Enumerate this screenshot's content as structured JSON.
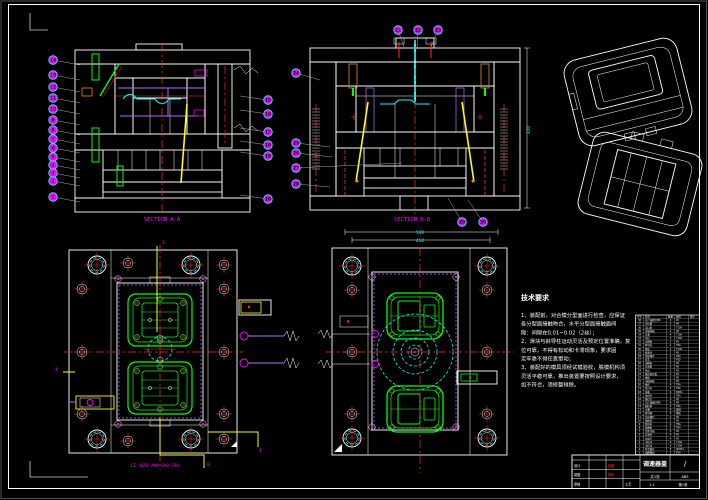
{
  "drawing": {
    "section_a_label": "SECTION A-A",
    "section_b_label": "SECTION B-B",
    "plan_caption": "CI-4050-A90-B90-C90",
    "dim_top_1": "540",
    "dim_top_2": "450",
    "dim_right_b": "320",
    "leader_numbers": [
      "3",
      "8",
      "4",
      "4"
    ]
  },
  "colors": {
    "accent_magenta": "#ff00ff",
    "accent_cyan": "#00ffff",
    "accent_green": "#00ff00",
    "accent_yellow": "#ffff00",
    "accent_red": "#ff2a2a",
    "line_white": "#ffffff"
  },
  "tech_req": {
    "title": "技术要求",
    "lines": [
      "1、装配前，对合模分型面进行检查，应保证",
      "各分型面接触吻合，水平分型面接触面间",
      "隙：间隙在0.01~0.02（2丝）；",
      "2、滑块与斜导柱运动灵活及预定位置准确，复",
      "位可靠，不得有松动和卡滞现象，要求固",
      "定牢靠不得任意窜动；",
      "3、装配好的模具须经试模验收，脱模机构须",
      "灵活平稳可靠，推出装置要按照设计要求，",
      "如不符合，须修整排除。"
    ]
  },
  "balloons": {
    "a_left": [
      "14",
      "13",
      "12",
      "11",
      "10",
      "9",
      "8",
      "7",
      "6",
      "5",
      "4",
      "3",
      "2",
      "1"
    ],
    "a_right": [
      "15",
      "16",
      "17",
      "18",
      "19",
      "20"
    ],
    "b_top": [
      "21",
      "22",
      "23"
    ],
    "b_left_top": [
      "24"
    ],
    "b_left": [
      "25",
      "26",
      "27",
      "28"
    ],
    "b_bottom": [
      "29",
      "30"
    ]
  },
  "bom": {
    "headers": [
      "序号",
      "名称",
      "数量",
      "材料",
      "备注"
    ],
    "rows": [
      [
        "38",
        "内六角螺钉M8",
        "4",
        "45",
        ""
      ],
      [
        "37",
        "定位圈",
        "1",
        "45",
        ""
      ],
      [
        "36",
        "浇口套",
        "1",
        "T10A",
        ""
      ],
      [
        "35",
        "定模座板",
        "1",
        "45",
        ""
      ],
      [
        "34",
        "导套",
        "4",
        "T10A",
        ""
      ],
      [
        "33",
        "导柱",
        "4",
        "T10A",
        ""
      ],
      [
        "32",
        "定模板",
        "1",
        "45",
        ""
      ],
      [
        "31",
        "斜导柱",
        "2",
        "T8A",
        ""
      ],
      [
        "30",
        "滑块",
        "2",
        "T10A",
        ""
      ],
      [
        "29",
        "楔紧块",
        "2",
        "45",
        ""
      ],
      [
        "28",
        "型腔镶件",
        "2",
        "P20",
        ""
      ],
      [
        "27",
        "型芯",
        "2",
        "P20",
        ""
      ],
      [
        "26",
        "动模板",
        "1",
        "45",
        ""
      ],
      [
        "25",
        "支承板",
        "1",
        "45",
        ""
      ],
      [
        "24",
        "垫块",
        "2",
        "45",
        ""
      ],
      [
        "23",
        "推杆固定板",
        "1",
        "45",
        ""
      ],
      [
        "22",
        "推板",
        "1",
        "45",
        ""
      ],
      [
        "21",
        "动模座板",
        "1",
        "45",
        ""
      ],
      [
        "20",
        "推杆",
        "8",
        "T8A",
        ""
      ],
      [
        "19",
        "复位杆",
        "4",
        "T8A",
        ""
      ],
      [
        "18",
        "弹簧",
        "4",
        "65Mn",
        ""
      ],
      [
        "17",
        "拉料杆",
        "1",
        "T8A",
        ""
      ],
      [
        "16",
        "限位钉",
        "4",
        "45",
        ""
      ],
      [
        "15",
        "内六角螺钉M6",
        "6",
        "45",
        ""
      ],
      [
        "14",
        "圆柱销",
        "4",
        "T8A",
        ""
      ],
      [
        "13",
        "水嘴",
        "8",
        "黄铜",
        ""
      ],
      [
        "12",
        "密封圈",
        "8",
        "橡胶",
        ""
      ],
      [
        "11",
        "吊环螺钉",
        "2",
        "45",
        ""
      ],
      [
        "10",
        "锁模块",
        "2",
        "45",
        ""
      ],
      [
        "9",
        "斜顶杆",
        "2",
        "T8A",
        ""
      ],
      [
        "8",
        "耐磨板",
        "2",
        "T8A",
        ""
      ],
      [
        "7",
        "定距拉板",
        "2",
        "45",
        ""
      ],
      [
        "6",
        "支承柱",
        "4",
        "45",
        ""
      ],
      [
        "5",
        "垃圾钉",
        "4",
        "45",
        ""
      ],
      [
        "4",
        "中托司",
        "4",
        "T10A",
        ""
      ],
      [
        "3",
        "中托边",
        "4",
        "T10A",
        ""
      ],
      [
        "2",
        "型芯镶针",
        "8",
        "SKH51",
        ""
      ],
      [
        "1",
        "动模镶块",
        "2",
        "P20",
        ""
      ]
    ]
  },
  "title_block": {
    "part_name": "调速器盖",
    "scale": "/",
    "material": "ABS",
    "count_label": "共1张",
    "sheet_label": "第1张",
    "ratio": "1:1",
    "strip_labels": [
      "标记",
      "处数",
      "分区",
      "更改文件号",
      "签名",
      "年月日"
    ],
    "design_label": "设计",
    "draw_label": "制图",
    "check_label": "审核",
    "process_label": "工艺",
    "trace_label": "描图",
    "trace_check_label": "描校"
  }
}
